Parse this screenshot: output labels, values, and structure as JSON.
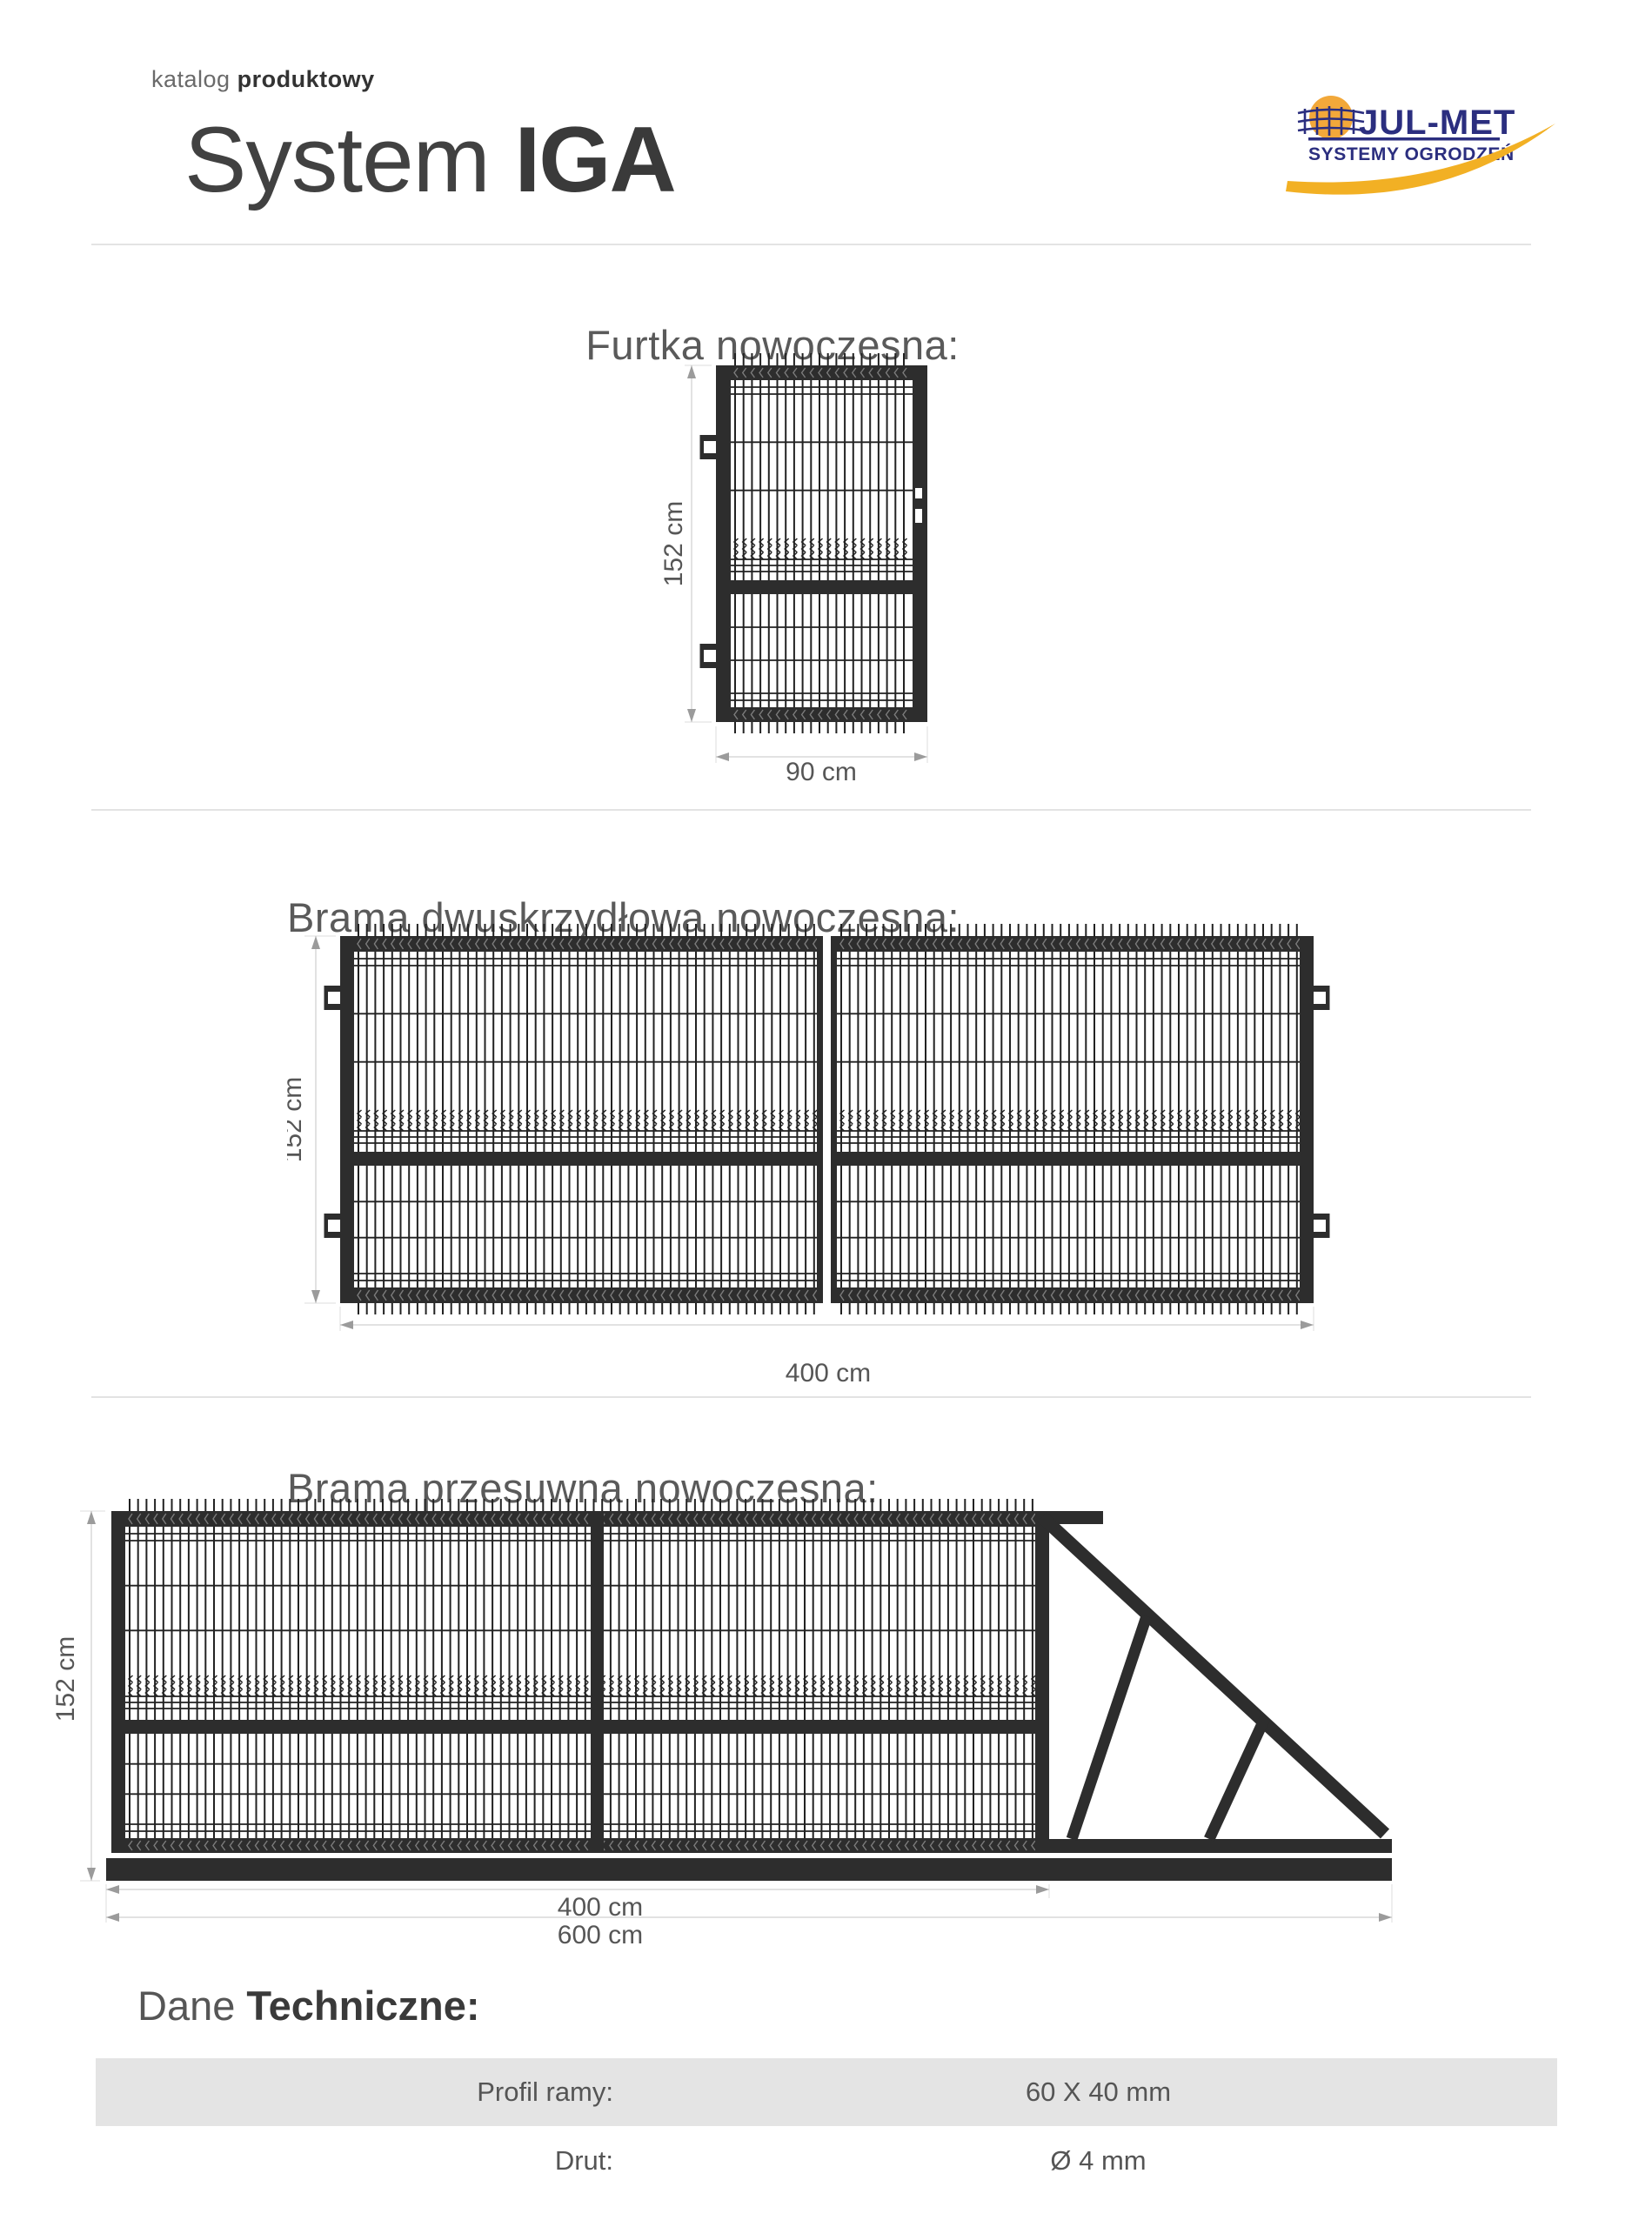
{
  "header": {
    "kicker": {
      "light": "katalog",
      "bold": "produktowy"
    },
    "title": {
      "light": "System",
      "bold": "IGA"
    },
    "logo": {
      "name": "JUL-MET",
      "tagline": "SYSTEMY OGRODZEŃ",
      "navy": "#2b2e7f",
      "orange": "#f2a83a",
      "yellow": "#f2b024"
    }
  },
  "sections": [
    {
      "heading": "Furtka nowoczesna:",
      "dims": {
        "height": "152 cm",
        "width": "90 cm"
      }
    },
    {
      "heading": "Brama dwuskrzydłowa nowoczesna:",
      "dims": {
        "height": "152 cm",
        "width": "400 cm"
      }
    },
    {
      "heading": "Brama przesuwna nowoczesna:",
      "dims": {
        "height": "152 cm",
        "width_gate": "400 cm",
        "width_total": "600 cm"
      }
    }
  ],
  "tech": {
    "heading": {
      "light": "Dane",
      "bold": "Techniczne:"
    },
    "rows": [
      {
        "label": "Profil ramy:",
        "value": "60 X 40 mm"
      },
      {
        "label": "Drut:",
        "value": "Ø 4 mm"
      }
    ]
  },
  "drawing_colors": {
    "frame": "#2d2d2d",
    "wire": "#222222",
    "dimension": "#9b9b9b",
    "dim_line": "#c6c6c6",
    "dim_text": "#565656"
  }
}
